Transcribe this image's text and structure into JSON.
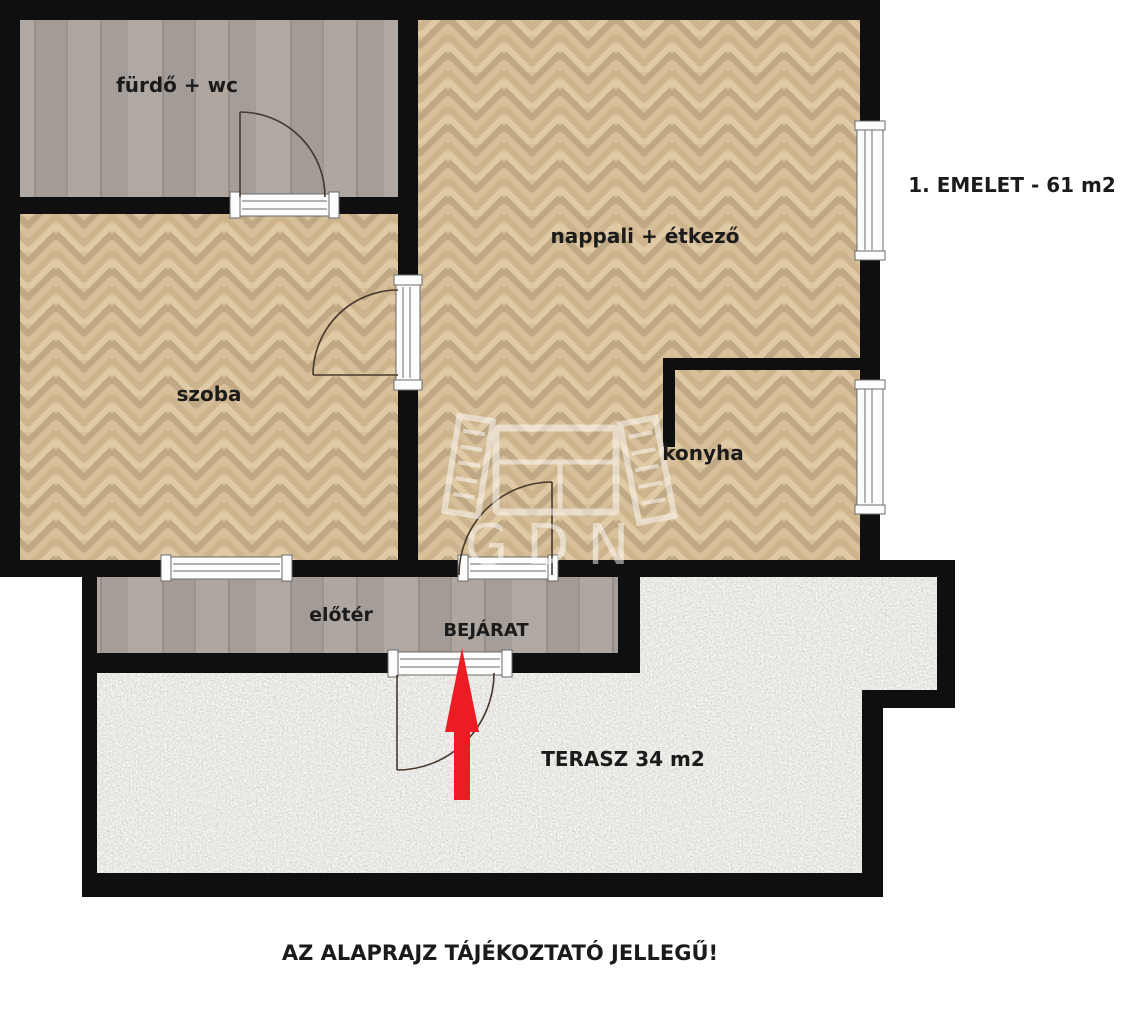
{
  "floor_plan": {
    "title": "1. EMELET - 61 m2",
    "disclaimer": "AZ ALAPRAJZ TÁJÉKOZTATÓ JELLEGŰ!",
    "watermark": "GDN",
    "rooms": {
      "bathroom": {
        "label": "fürdő + wc"
      },
      "living_dining": {
        "label": "nappali + étkező"
      },
      "bedroom": {
        "label": "szoba"
      },
      "kitchen": {
        "label": "konyha"
      },
      "hall": {
        "label": "előtér"
      },
      "entrance": {
        "label": "BEJÁRAT"
      },
      "terrace": {
        "label": "TERASZ 34 m2"
      }
    },
    "colors": {
      "wall": "#0f0f0f",
      "wood_floor_base": "#d7c098",
      "gray_floor_base": "#a8a09b",
      "terrace_floor": "#ccc9c0",
      "arrow_red": "#ec1c24",
      "label_text": "#1b1b1b"
    }
  }
}
